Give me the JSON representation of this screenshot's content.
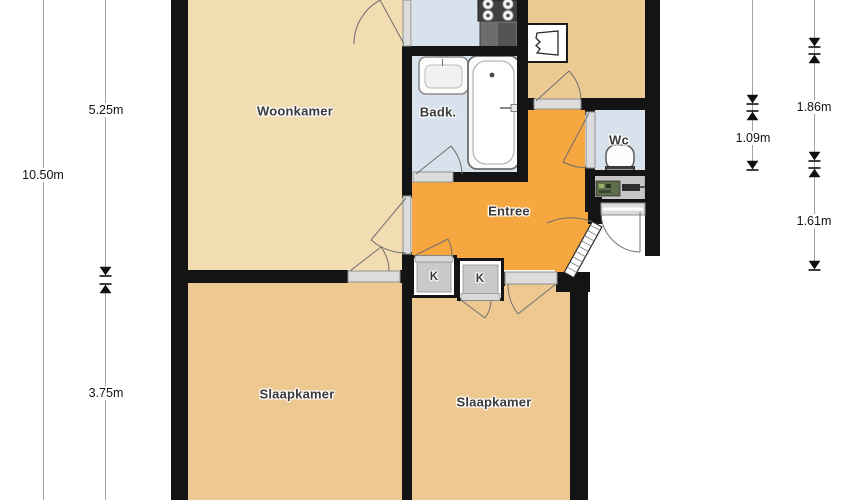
{
  "floorplan": {
    "rooms": {
      "woonkamer": {
        "label": "Woonkamer"
      },
      "badkamer": {
        "label": "Badk."
      },
      "entree": {
        "label": "Entree"
      },
      "wc": {
        "label": "Wc"
      },
      "slaapkamer_links": {
        "label": "Slaapkamer"
      },
      "slaapkamer_rechts": {
        "label": "Slaapkamer"
      },
      "kast_1": {
        "label": "K"
      },
      "kast_2": {
        "label": "K"
      }
    },
    "dimensions": {
      "left_total": "10.50m",
      "left_upper": "5.25m",
      "left_lower": "3.75m",
      "right_middle": "1.09m",
      "right_upper": "1.86m",
      "right_lower": "1.61m"
    },
    "colors": {
      "wall": "#141414",
      "woonkamer": "#F2DCB2",
      "slaapkamer": "#EDC890",
      "gang": "#ECCA92",
      "entree": "#F6A73F",
      "natte_ruimte": "#D7E2EC",
      "kast": "#C9C9C9",
      "meterkast": "#C6C6C6"
    },
    "icons": [
      "stove-icon",
      "counter-icon",
      "boiler-icon",
      "washbasin-icon",
      "bathtub-icon",
      "toilet-icon",
      "meter-cupboard-icon",
      "front-door-icon",
      "dimension-arrow-icon"
    ]
  }
}
